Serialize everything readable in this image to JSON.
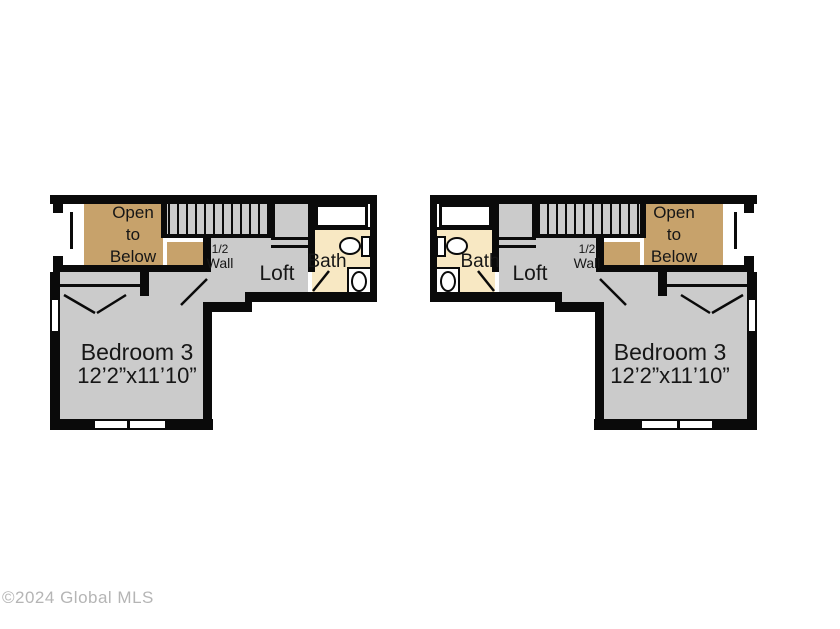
{
  "plan_labels": {
    "open_to_below_line1": "Open",
    "open_to_below_line2": "to",
    "open_to_below_line3": "Below",
    "half_wall_line1": "1/2",
    "half_wall_line2": "Wall",
    "loft": "Loft",
    "bath": "Bath",
    "bedroom_name": "Bedroom 3",
    "bedroom_dims": "12’2”x11’10”"
  },
  "watermark": "©2024 Global MLS",
  "colors": {
    "floor_gray": "#cbcbcb",
    "open_to_below_tan": "#c7a26b",
    "bath_cream": "#f8e8c3",
    "wall_black": "#0a0a0a",
    "watermark_gray": "#b5b5b5"
  }
}
